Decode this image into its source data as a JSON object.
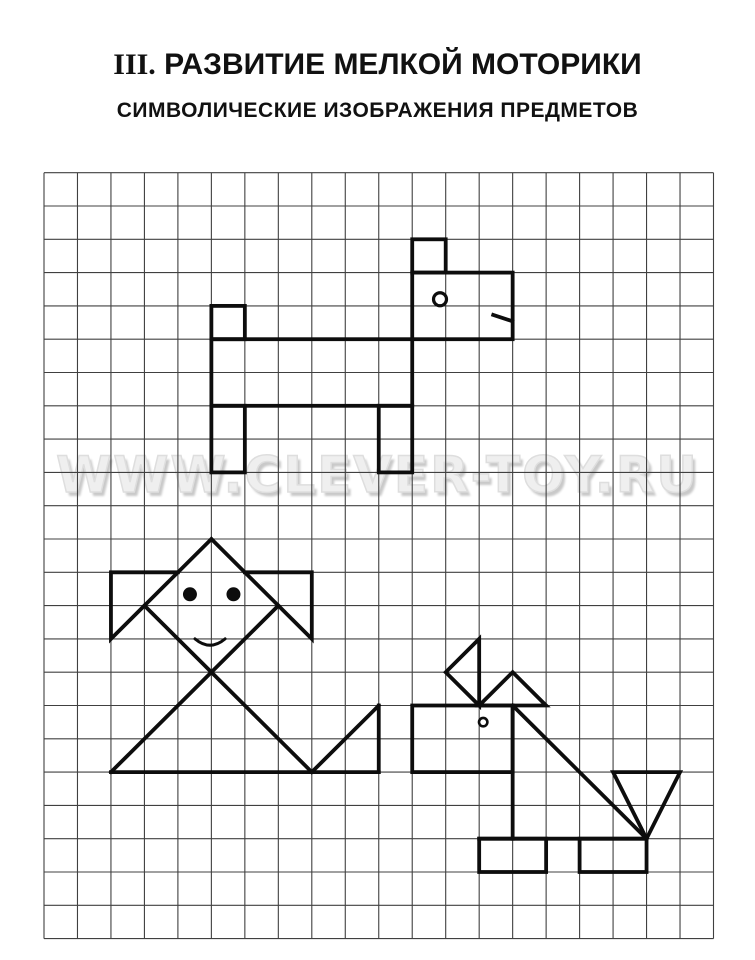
{
  "header": {
    "title_roman": "III.",
    "title_main": " РАЗВИТИЕ МЕЛКОЙ МОТОРИКИ",
    "subtitle": "СИМВОЛИЧЕСКИЕ ИЗОБРАЖЕНИЯ ПРЕДМЕТОВ"
  },
  "watermark": {
    "text": "WWW.CLEVER-TOY.RU"
  },
  "grid": {
    "x": 44,
    "y": 172.7,
    "cols": 20,
    "rows": 23,
    "cell_w": 33.475,
    "cell_h": 33.3,
    "line_color": "#404040",
    "line_width": 1.1,
    "figure_color": "#0d0d0d",
    "figure_stroke": 3.8
  },
  "figures": [
    {
      "name": "dog-top",
      "label": "symbolic dog drawn on squared grid",
      "rects": [
        [
          5,
          4,
          1,
          1
        ],
        [
          11,
          2,
          1,
          1
        ],
        [
          11,
          3,
          3,
          2
        ],
        [
          5,
          5,
          6,
          2
        ],
        [
          5,
          7,
          1,
          2
        ],
        [
          10,
          7,
          1,
          2
        ]
      ],
      "segments": [
        [
          13.42,
          4.27,
          13.99,
          4.46
        ]
      ],
      "circles": [
        {
          "c": [
            11.83,
            3.8
          ],
          "r": 6.5,
          "fill": false,
          "sw": 3.2
        }
      ]
    },
    {
      "name": "girl",
      "label": "symbolic girl with pigtails drawn on squared grid",
      "polylines": [
        [
          [
            4,
            12
          ],
          [
            2,
            12
          ],
          [
            2,
            14
          ],
          [
            3,
            13
          ]
        ],
        [
          [
            6,
            12
          ],
          [
            8,
            12
          ],
          [
            8,
            14
          ],
          [
            7,
            13
          ]
        ]
      ],
      "segments": [
        [
          5,
          11,
          3,
          13
        ],
        [
          5,
          11,
          7,
          13
        ],
        [
          3,
          13,
          8,
          18
        ],
        [
          7,
          13,
          2,
          18
        ],
        [
          2,
          18,
          10,
          18
        ],
        [
          8,
          18,
          10,
          16
        ],
        [
          10,
          16,
          10,
          18
        ]
      ],
      "circles": [
        {
          "c": [
            4.36,
            12.66
          ],
          "r": 6.5,
          "fill": true,
          "sw": 1
        },
        {
          "c": [
            5.66,
            12.66
          ],
          "r": 6.5,
          "fill": true,
          "sw": 1
        }
      ],
      "curves": [
        {
          "from": [
            4.51,
            14.0
          ],
          "ctrl": [
            4.96,
            14.38
          ],
          "to": [
            5.41,
            14.0
          ],
          "sw": 3
        }
      ]
    },
    {
      "name": "dog-bottom",
      "label": "symbolic dog / foal drawn on squared grid",
      "rects": [
        [
          11,
          16,
          3,
          2
        ],
        [
          13,
          20,
          2,
          1
        ],
        [
          16,
          20,
          2,
          1
        ]
      ],
      "polygons": [
        [
          [
            13,
            14
          ],
          [
            12,
            15
          ],
          [
            13,
            16
          ]
        ],
        [
          [
            14,
            15
          ],
          [
            13,
            16
          ],
          [
            15,
            16
          ]
        ],
        [
          [
            17,
            18
          ],
          [
            19,
            18
          ],
          [
            18,
            20
          ]
        ]
      ],
      "segments": [
        [
          14,
          16,
          14,
          20
        ],
        [
          14,
          16,
          18,
          20
        ],
        [
          13,
          20,
          18,
          20
        ]
      ],
      "circles": [
        {
          "c": [
            13.12,
            16.5
          ],
          "r": 4.2,
          "fill": false,
          "sw": 2.6
        }
      ]
    }
  ]
}
